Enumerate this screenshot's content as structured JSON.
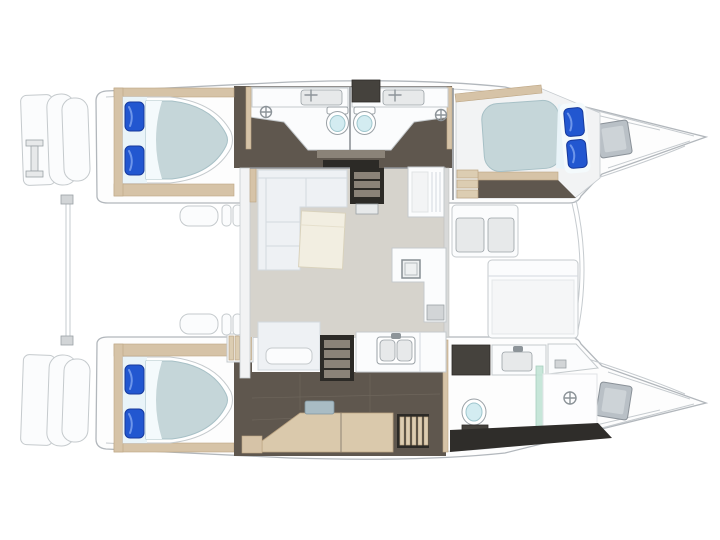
{
  "meta": {
    "title": "Catamaran interior floor plan, top-down view, bow to the right",
    "view": "top-down deck plan",
    "orientation": "bow-right",
    "image_text": []
  },
  "palette": {
    "hullFill": "#fdfdfd",
    "hullLine": "#b2b7bc",
    "deckLine": "#c6cbcf",
    "wall": "#8f9398",
    "darkFloor": "#5f574e",
    "darkCab": "#45423d",
    "darkCab2": "#2c2a26",
    "treadLight": "#8b8378",
    "woodTrim": "#d6c3a7",
    "woodStep": "#dccdb2",
    "woodEdge": "#bda583",
    "deskWood": "#dac9ac",
    "saloonFloor": "#d6d3cc",
    "furnWhite": "#fbfcfd",
    "furnLine": "#c5cacd",
    "sofaWhite": "#eef1f4",
    "sofaLine": "#d3d9de",
    "tableCream": "#f2eee1",
    "tableEdge": "#d9d2bc",
    "duvet": "#c5d6d9",
    "duvetEdge": "#a7c0c6",
    "sheet": "#e9f4f9",
    "sheetFold": "#f4fafc",
    "pillow": "#2257d0",
    "pillowDeep": "#16399c",
    "pillowHi": "#6e96ea",
    "toiletBowl": "#d3ecf1",
    "toiletLine": "#9fc6cd",
    "fixLine": "#9aa1a6",
    "inset": "#e7e9ea",
    "insetDeep": "#d2d5d7",
    "steel": "#8d9499",
    "glass": "#c2e4d6",
    "glassEdge": "#9ecab8",
    "hatch": "#b9c0c6",
    "hatchInner": "#cdd3d7",
    "hatchEdge": "#8a9198",
    "charcoal": "#2f2d2a",
    "seam": "#6e665c",
    "laptop": "#a9bcc4"
  },
  "vessel": {
    "type": "catamaran",
    "cabins": 3,
    "heads": 3,
    "double_berths": 3,
    "upper_hull": {
      "aft": "double cabin, bed with 2 blue pillows, wood trim surround",
      "midship": "two mirrored en-suite bathrooms, each with sink counter, toilet and shower head, dark cabinet between them",
      "forward": "double cabin, bed with 2 blue pillows, wood steps, deck hatch in bow"
    },
    "lower_hull": {
      "aft": "owner double cabin, bed with 2 blue pillows, wood trim surround",
      "midship": "desk / vanity in wood with seat and tablet, slatted floor panel, companionway steps",
      "forward": "owner bathroom: dark vanity cabinet, sink counter, toilet on dark pedestal, glass shower screen, shower head, charcoal floor band, deck hatch in bow"
    },
    "bridgedeck": {
      "saloon": [
        "L-shaped sofa",
        "cream coffee table",
        "aft bench seat",
        "galley counter with double sink and faucet",
        "L-shaped island counter with cooktop",
        "tall louvered cabinet",
        "companionway steps to each hull"
      ],
      "foredeck": [
        "slatted step box",
        "sun lounge with twin cushions",
        "forward lounge bench"
      ],
      "aft": [
        "twin transom swim platforms with steps",
        "boarding ladder on upper platform",
        "aft crossbeam with end cleats"
      ]
    }
  }
}
